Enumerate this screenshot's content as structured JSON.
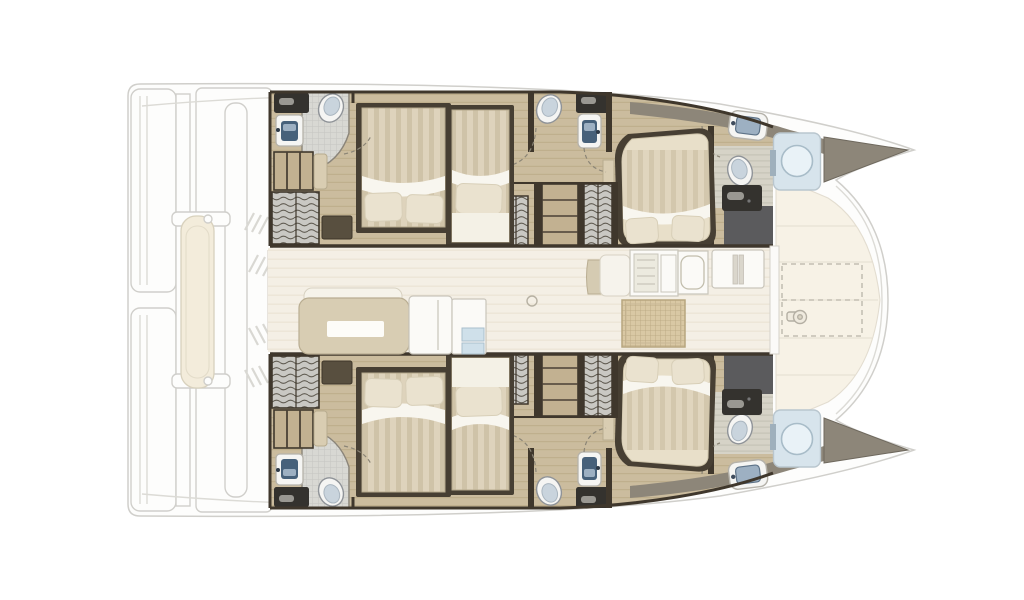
{
  "document": {
    "title": "Catamaran interior deck plan",
    "type": "yacht floor plan, top-down view, bow to the right, no text labels"
  },
  "palette": {
    "background": "#ffffff",
    "exterior": "#fdfdfc",
    "exteriorLine": "#d0cfcb",
    "wood": "#cbbc9e",
    "woodGrain": "#b9a884",
    "wall": "#3f372c",
    "bedFrame": "#473f33",
    "mattress": "#ded3bc",
    "mattressStripe": "#cfc3a8",
    "sheet": "#f8f6ef",
    "pillow": "#eae2cf",
    "tile": "#d8d8d3",
    "tileLine": "#c5c5c0",
    "locker": "#c9c8c3",
    "lockerWave": "#5f5a50",
    "charcoal": "#34322e",
    "handle": "#9a9892",
    "porcelain": "#f5f5f3",
    "basin": "#47617a",
    "basinLight": "#9db0c2",
    "glass": "#d7e4ec",
    "glassRing": "#a8bcc8",
    "taupe": "#8d8679",
    "showerFloor": "#5b5b5d",
    "bathFloor": "#d6d3c7",
    "corridor": "#f4efe5",
    "sofa": "#d8cdb3",
    "backrest": "#f6f3ea",
    "module": "#fbfaf7",
    "hatch": "#d9c8a4",
    "hatchLine": "#b7a67f",
    "shelfWood": "#c2b191",
    "pouf": "#584f3f",
    "benchWood": "#d9cdb2",
    "dinghy": "#f3ecdb",
    "foredeck": "#f7f2e6",
    "bulkhead": "#fbfaf8"
  },
  "inventory": {
    "hulls": 2,
    "double_beds": 4,
    "mid_berths": 2,
    "island_beds": 2,
    "toilets": 6,
    "sinks": 6,
    "shower_stalls": 2,
    "hanging_lockers": 6,
    "shelf_units": 4,
    "saloon_items": [
      "sofa",
      "storage-cabinets",
      "glass-front-cabinet",
      "bench-seat",
      "galley-stove-unit",
      "galley-sink-unit",
      "fridge",
      "floor-hatch",
      "compass-mark"
    ],
    "exterior_items": [
      "swim-platforms",
      "davits",
      "dinghy",
      "cockpit-posts",
      "vent-slashes",
      "foredeck-sunpads",
      "trampoline-outline",
      "windlass",
      "bow-crossbeam-arc"
    ]
  }
}
